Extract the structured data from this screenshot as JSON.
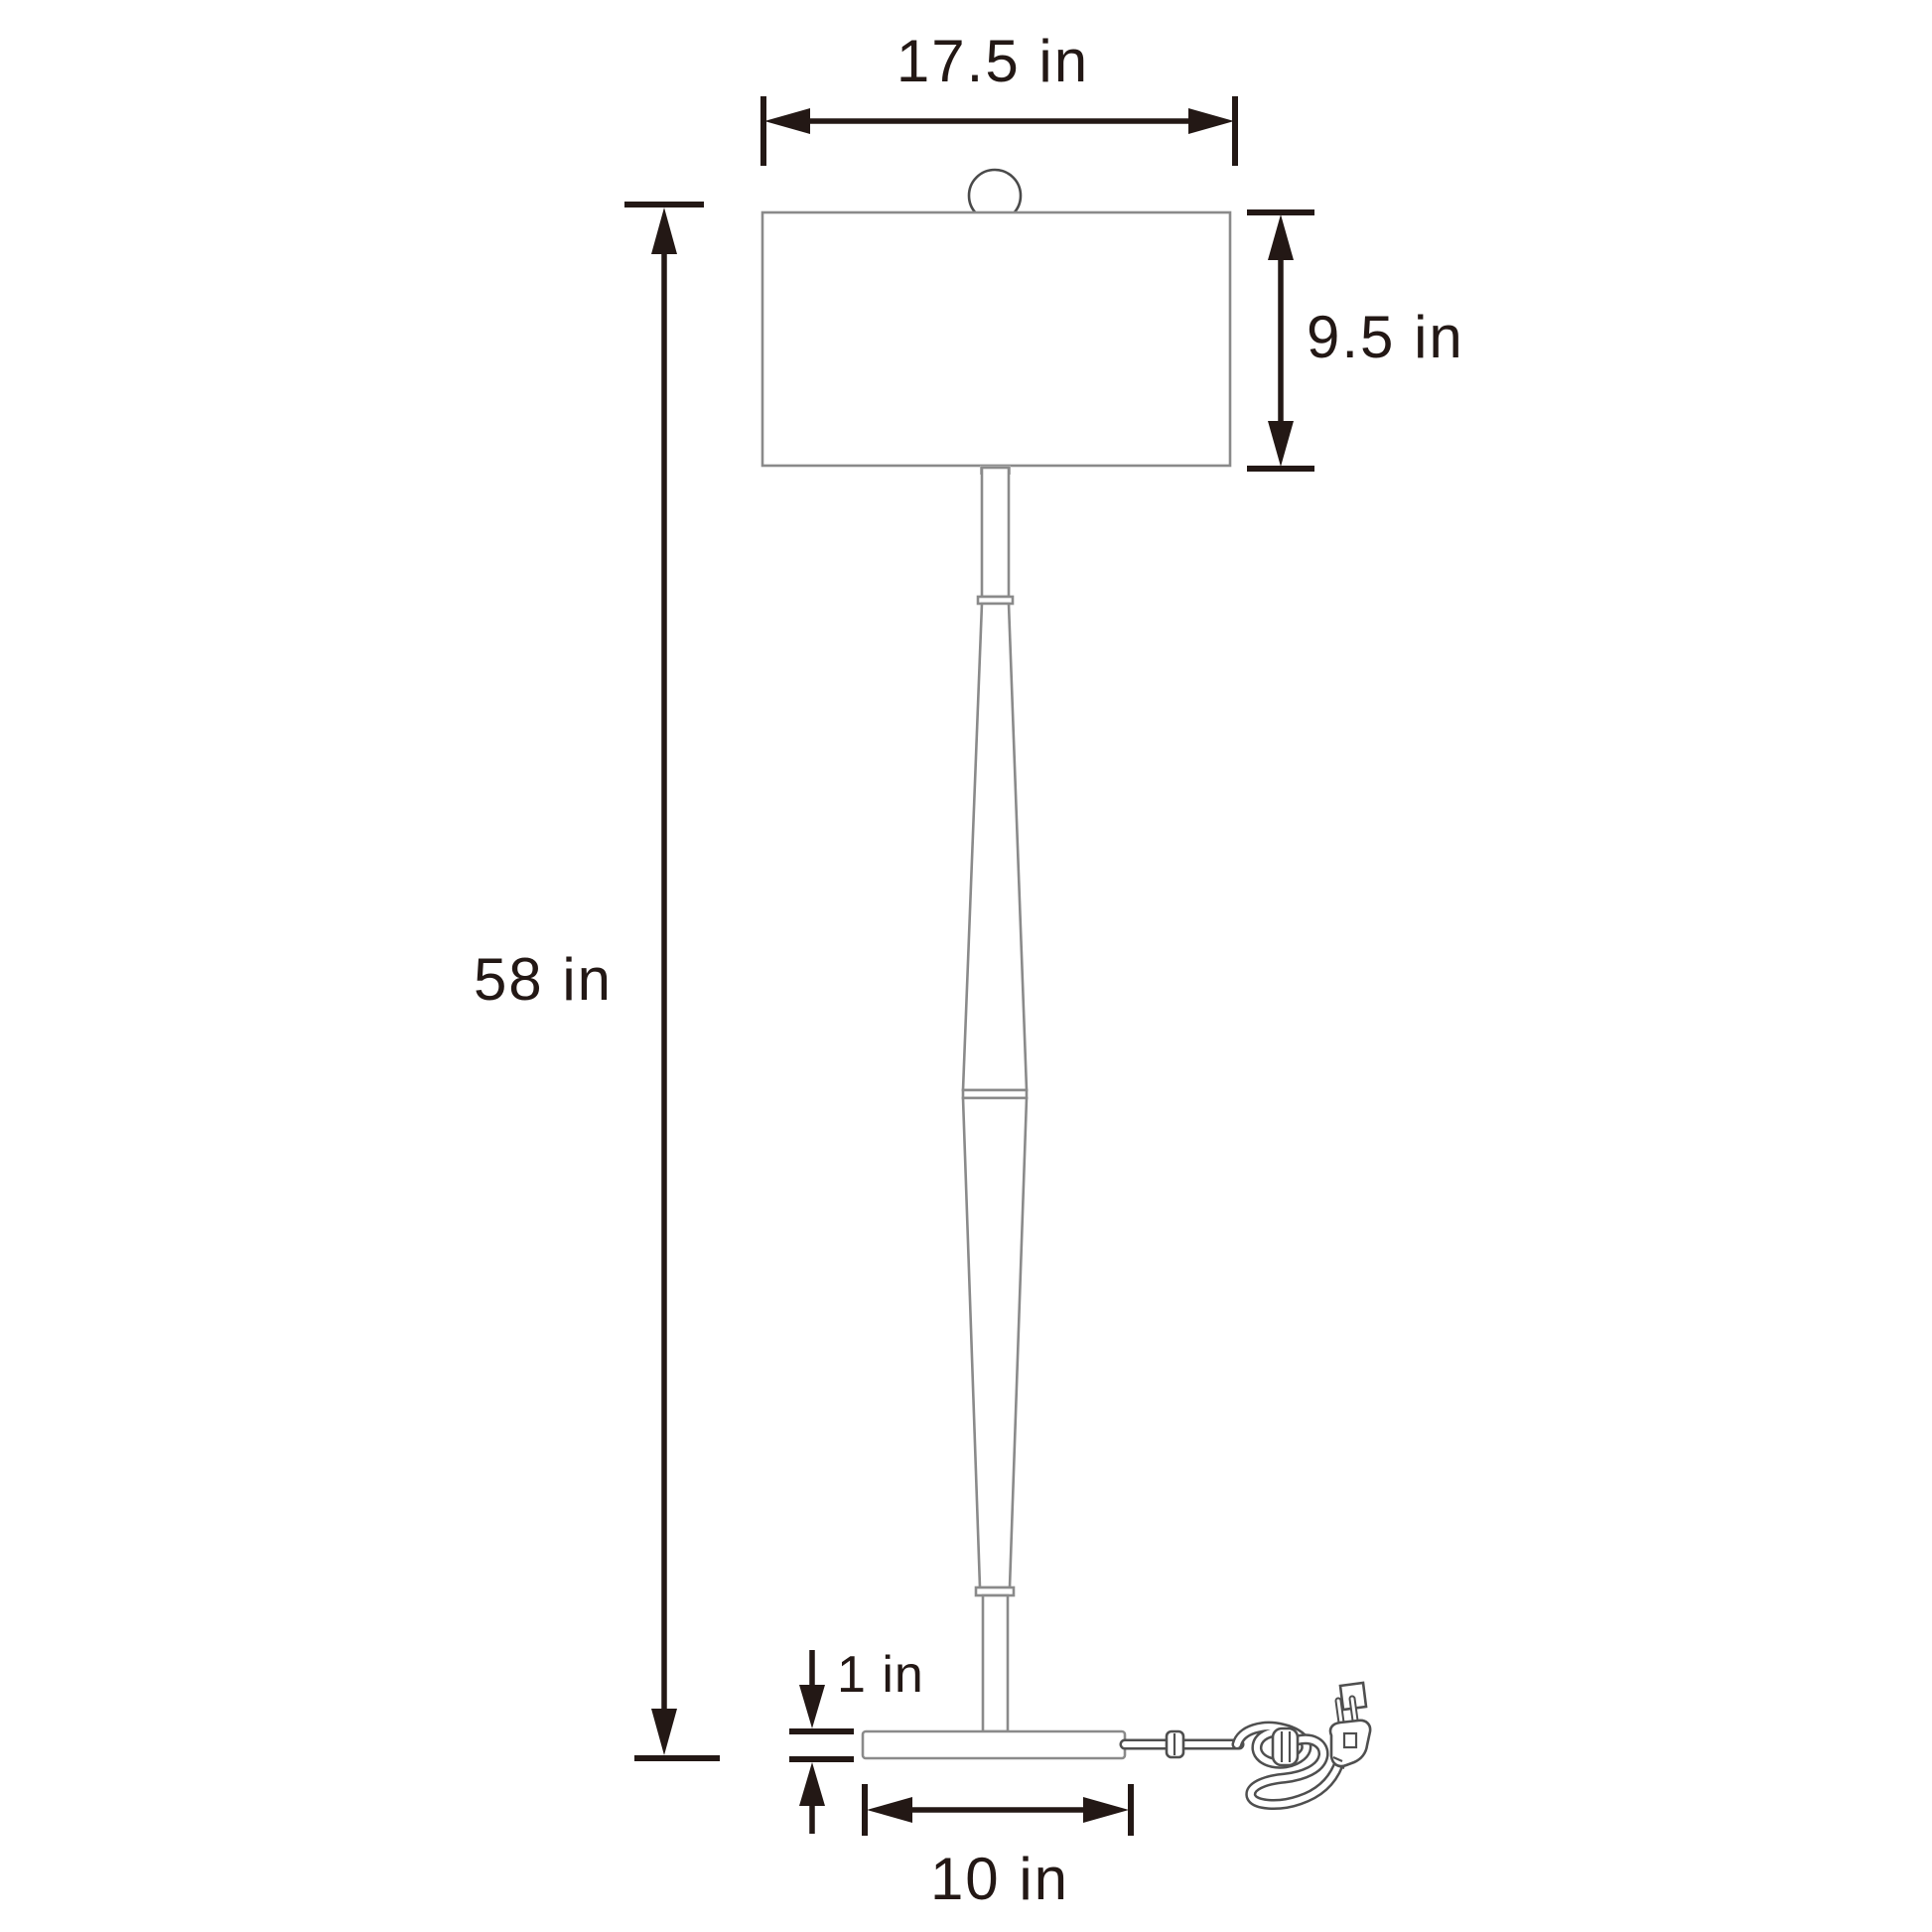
{
  "diagram": {
    "subject": "floor-lamp-dimension-drawing",
    "labels": {
      "shade_width": "17.5 in",
      "shade_height": "9.5 in",
      "total_height": "58 in",
      "base_thickness": "1 in",
      "base_width": "10 in"
    },
    "colors": {
      "background": "#ffffff",
      "dimension_ink": "#231815",
      "lamp_outline": "#8a8a8a",
      "cord_ink": "#4f4f4f"
    }
  }
}
